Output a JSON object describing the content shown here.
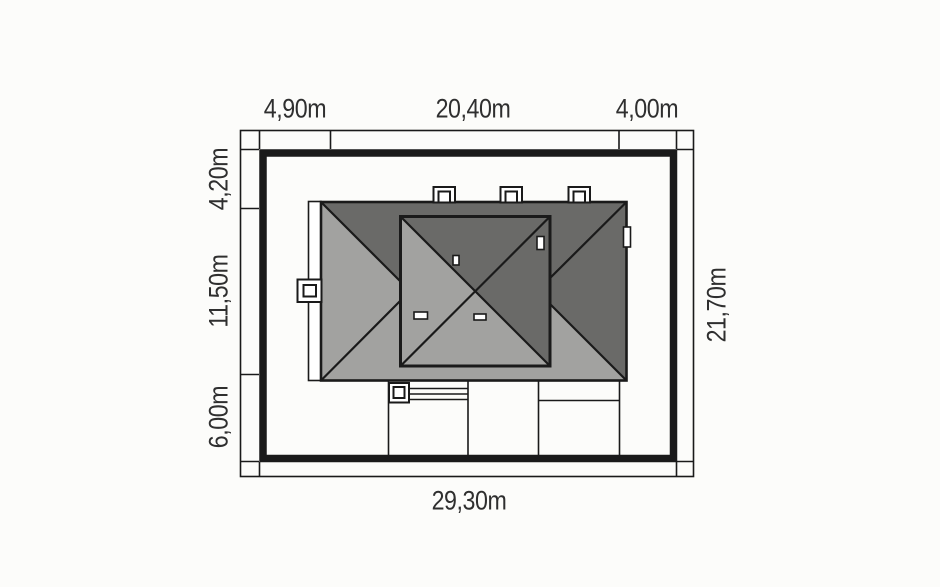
{
  "plan": {
    "type": "house-site-plan",
    "dimensions": {
      "top": [
        "4,90m",
        "20,40m",
        "4,00m"
      ],
      "left": [
        "4,20m",
        "11,50m",
        "6,00m"
      ],
      "right": "21,70m",
      "bottom": "29,30m"
    }
  },
  "colors": {
    "background": "#fcfcfa",
    "line": "#1a1a1a",
    "text": "#2f2f2f",
    "roof_light": "#a2a2a0",
    "roof_dark": "#6a6a68"
  }
}
